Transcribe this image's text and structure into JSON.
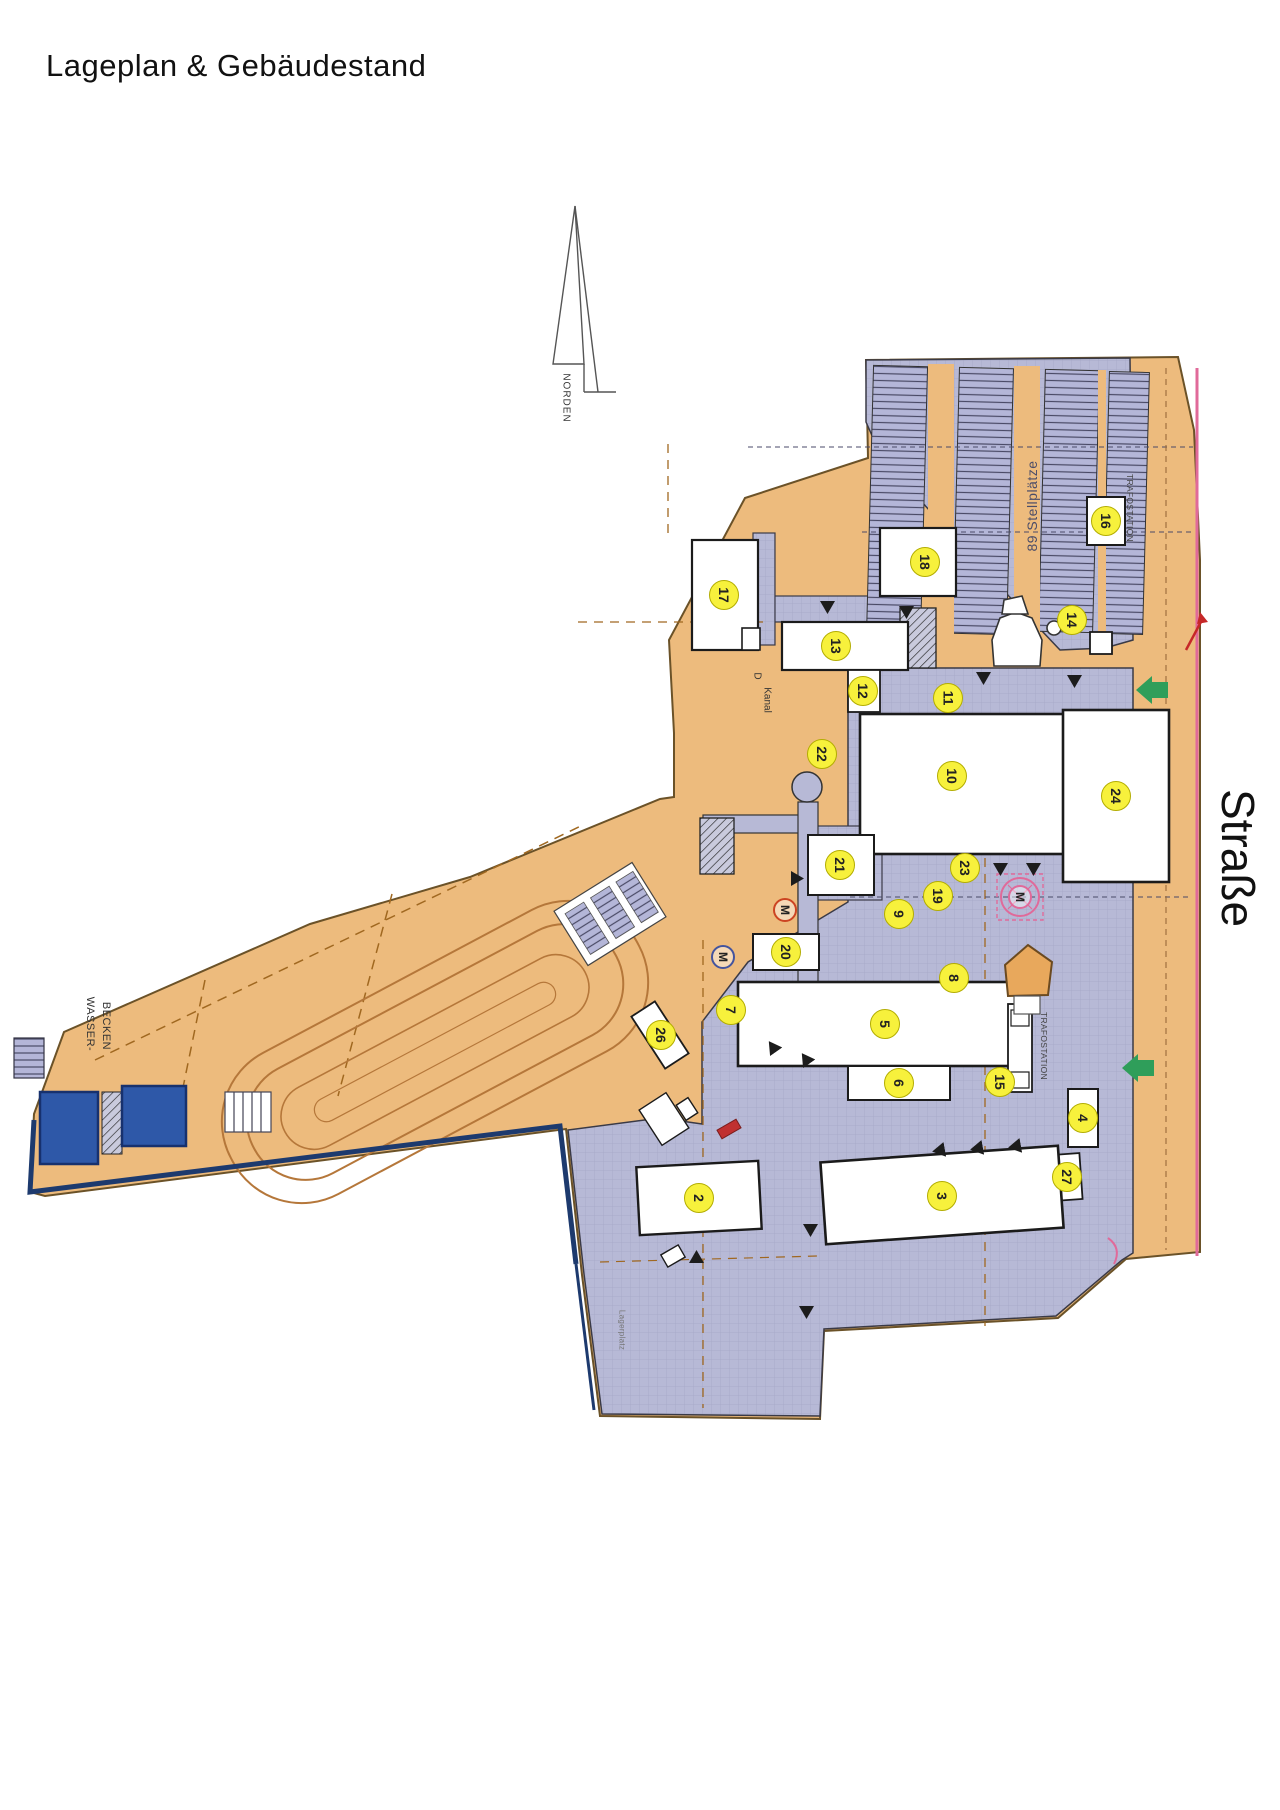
{
  "title": "Lageplan & Gebäudestand",
  "colors": {
    "land": "#edbb7d",
    "land_border": "#6b5228",
    "paving": "#b7b9d6",
    "badge_fill": "#f7f13c",
    "badge_border": "#b3ad00",
    "water": "#2e58a8",
    "boundary_navy": "#1d3a6e",
    "accent_pink": "#e06a9a",
    "accent_green": "#2f9e5a",
    "accent_red": "#c62828"
  },
  "labels": [
    {
      "id": "norden",
      "text": "NORDEN",
      "x": 566,
      "y": 398,
      "rot": 90,
      "size": 10,
      "color": "#333",
      "spacing": 1
    },
    {
      "id": "street-name",
      "text": "Straße",
      "x": 1238,
      "y": 858,
      "rot": 90,
      "size": 46,
      "color": "#111",
      "spacing": 0
    },
    {
      "id": "parking-count",
      "text": "89 Stellplätze",
      "x": 1032,
      "y": 506,
      "rot": -90,
      "size": 14,
      "color": "#4c4d68",
      "spacing": 0.5
    },
    {
      "id": "trafo-north",
      "text": "TRAFOSTATION",
      "x": 1130,
      "y": 508,
      "rot": 90,
      "size": 8.5,
      "color": "#444",
      "spacing": 0.3
    },
    {
      "id": "trafo-south",
      "text": "TRAFOSTATION",
      "x": 1044,
      "y": 1046,
      "rot": 90,
      "size": 8.5,
      "color": "#444",
      "spacing": 0.3
    },
    {
      "id": "kanal-d",
      "text": "D",
      "x": 757,
      "y": 676,
      "rot": 90,
      "size": 10,
      "color": "#333",
      "spacing": 0
    },
    {
      "id": "kanal",
      "text": "Kanal",
      "x": 767,
      "y": 700,
      "rot": 90,
      "size": 10,
      "color": "#333",
      "spacing": 0
    },
    {
      "id": "wasser-1",
      "text": "WASSER-",
      "x": 90,
      "y": 1024,
      "rot": 90,
      "size": 11,
      "color": "#333",
      "spacing": 0.5
    },
    {
      "id": "wasser-2",
      "text": "BECKEN",
      "x": 106,
      "y": 1026,
      "rot": 90,
      "size": 11,
      "color": "#333",
      "spacing": 0.5
    },
    {
      "id": "lagerplatz",
      "text": "Lagerplatz",
      "x": 622,
      "y": 1330,
      "rot": 90,
      "size": 8,
      "color": "#777",
      "spacing": 0.3
    }
  ],
  "badges": [
    {
      "n": "2",
      "x": 699,
      "y": 1198
    },
    {
      "n": "3",
      "x": 942,
      "y": 1196
    },
    {
      "n": "4",
      "x": 1083,
      "y": 1118
    },
    {
      "n": "5",
      "x": 885,
      "y": 1024
    },
    {
      "n": "6",
      "x": 899,
      "y": 1083
    },
    {
      "n": "7",
      "x": 731,
      "y": 1010
    },
    {
      "n": "8",
      "x": 954,
      "y": 978
    },
    {
      "n": "9",
      "x": 899,
      "y": 914
    },
    {
      "n": "10",
      "x": 952,
      "y": 776
    },
    {
      "n": "11",
      "x": 948,
      "y": 698
    },
    {
      "n": "12",
      "x": 863,
      "y": 691
    },
    {
      "n": "13",
      "x": 836,
      "y": 646
    },
    {
      "n": "14",
      "x": 1072,
      "y": 620
    },
    {
      "n": "15",
      "x": 1000,
      "y": 1082
    },
    {
      "n": "16",
      "x": 1106,
      "y": 521
    },
    {
      "n": "17",
      "x": 724,
      "y": 595
    },
    {
      "n": "18",
      "x": 925,
      "y": 562
    },
    {
      "n": "19",
      "x": 938,
      "y": 896
    },
    {
      "n": "20",
      "x": 786,
      "y": 952
    },
    {
      "n": "21",
      "x": 840,
      "y": 865
    },
    {
      "n": "22",
      "x": 822,
      "y": 754
    },
    {
      "n": "23",
      "x": 965,
      "y": 868
    },
    {
      "n": "24",
      "x": 1116,
      "y": 796
    },
    {
      "n": "26",
      "x": 661,
      "y": 1035
    },
    {
      "n": "27",
      "x": 1067,
      "y": 1177
    }
  ],
  "m_markers": [
    {
      "x": 785,
      "y": 910,
      "ring": "#cc4422"
    },
    {
      "x": 723,
      "y": 957,
      "ring": "#44549e"
    },
    {
      "x": 1020,
      "y": 897,
      "ring": "#e06a9a"
    }
  ],
  "triangles": [
    {
      "x": 827,
      "y": 607,
      "rot": 180
    },
    {
      "x": 906,
      "y": 612,
      "rot": 180
    },
    {
      "x": 983,
      "y": 678,
      "rot": 180
    },
    {
      "x": 1074,
      "y": 681,
      "rot": 180
    },
    {
      "x": 1000,
      "y": 869,
      "rot": 180
    },
    {
      "x": 1033,
      "y": 869,
      "rot": 180
    },
    {
      "x": 797,
      "y": 878,
      "rot": 90
    },
    {
      "x": 805,
      "y": 1058,
      "rot": -35
    },
    {
      "x": 772,
      "y": 1046,
      "rot": -35
    },
    {
      "x": 938,
      "y": 1150,
      "rot": -100
    },
    {
      "x": 976,
      "y": 1148,
      "rot": -100
    },
    {
      "x": 1014,
      "y": 1146,
      "rot": -100
    },
    {
      "x": 696,
      "y": 1256,
      "rot": 0
    },
    {
      "x": 810,
      "y": 1230,
      "rot": 180
    },
    {
      "x": 806,
      "y": 1312,
      "rot": 180
    }
  ]
}
